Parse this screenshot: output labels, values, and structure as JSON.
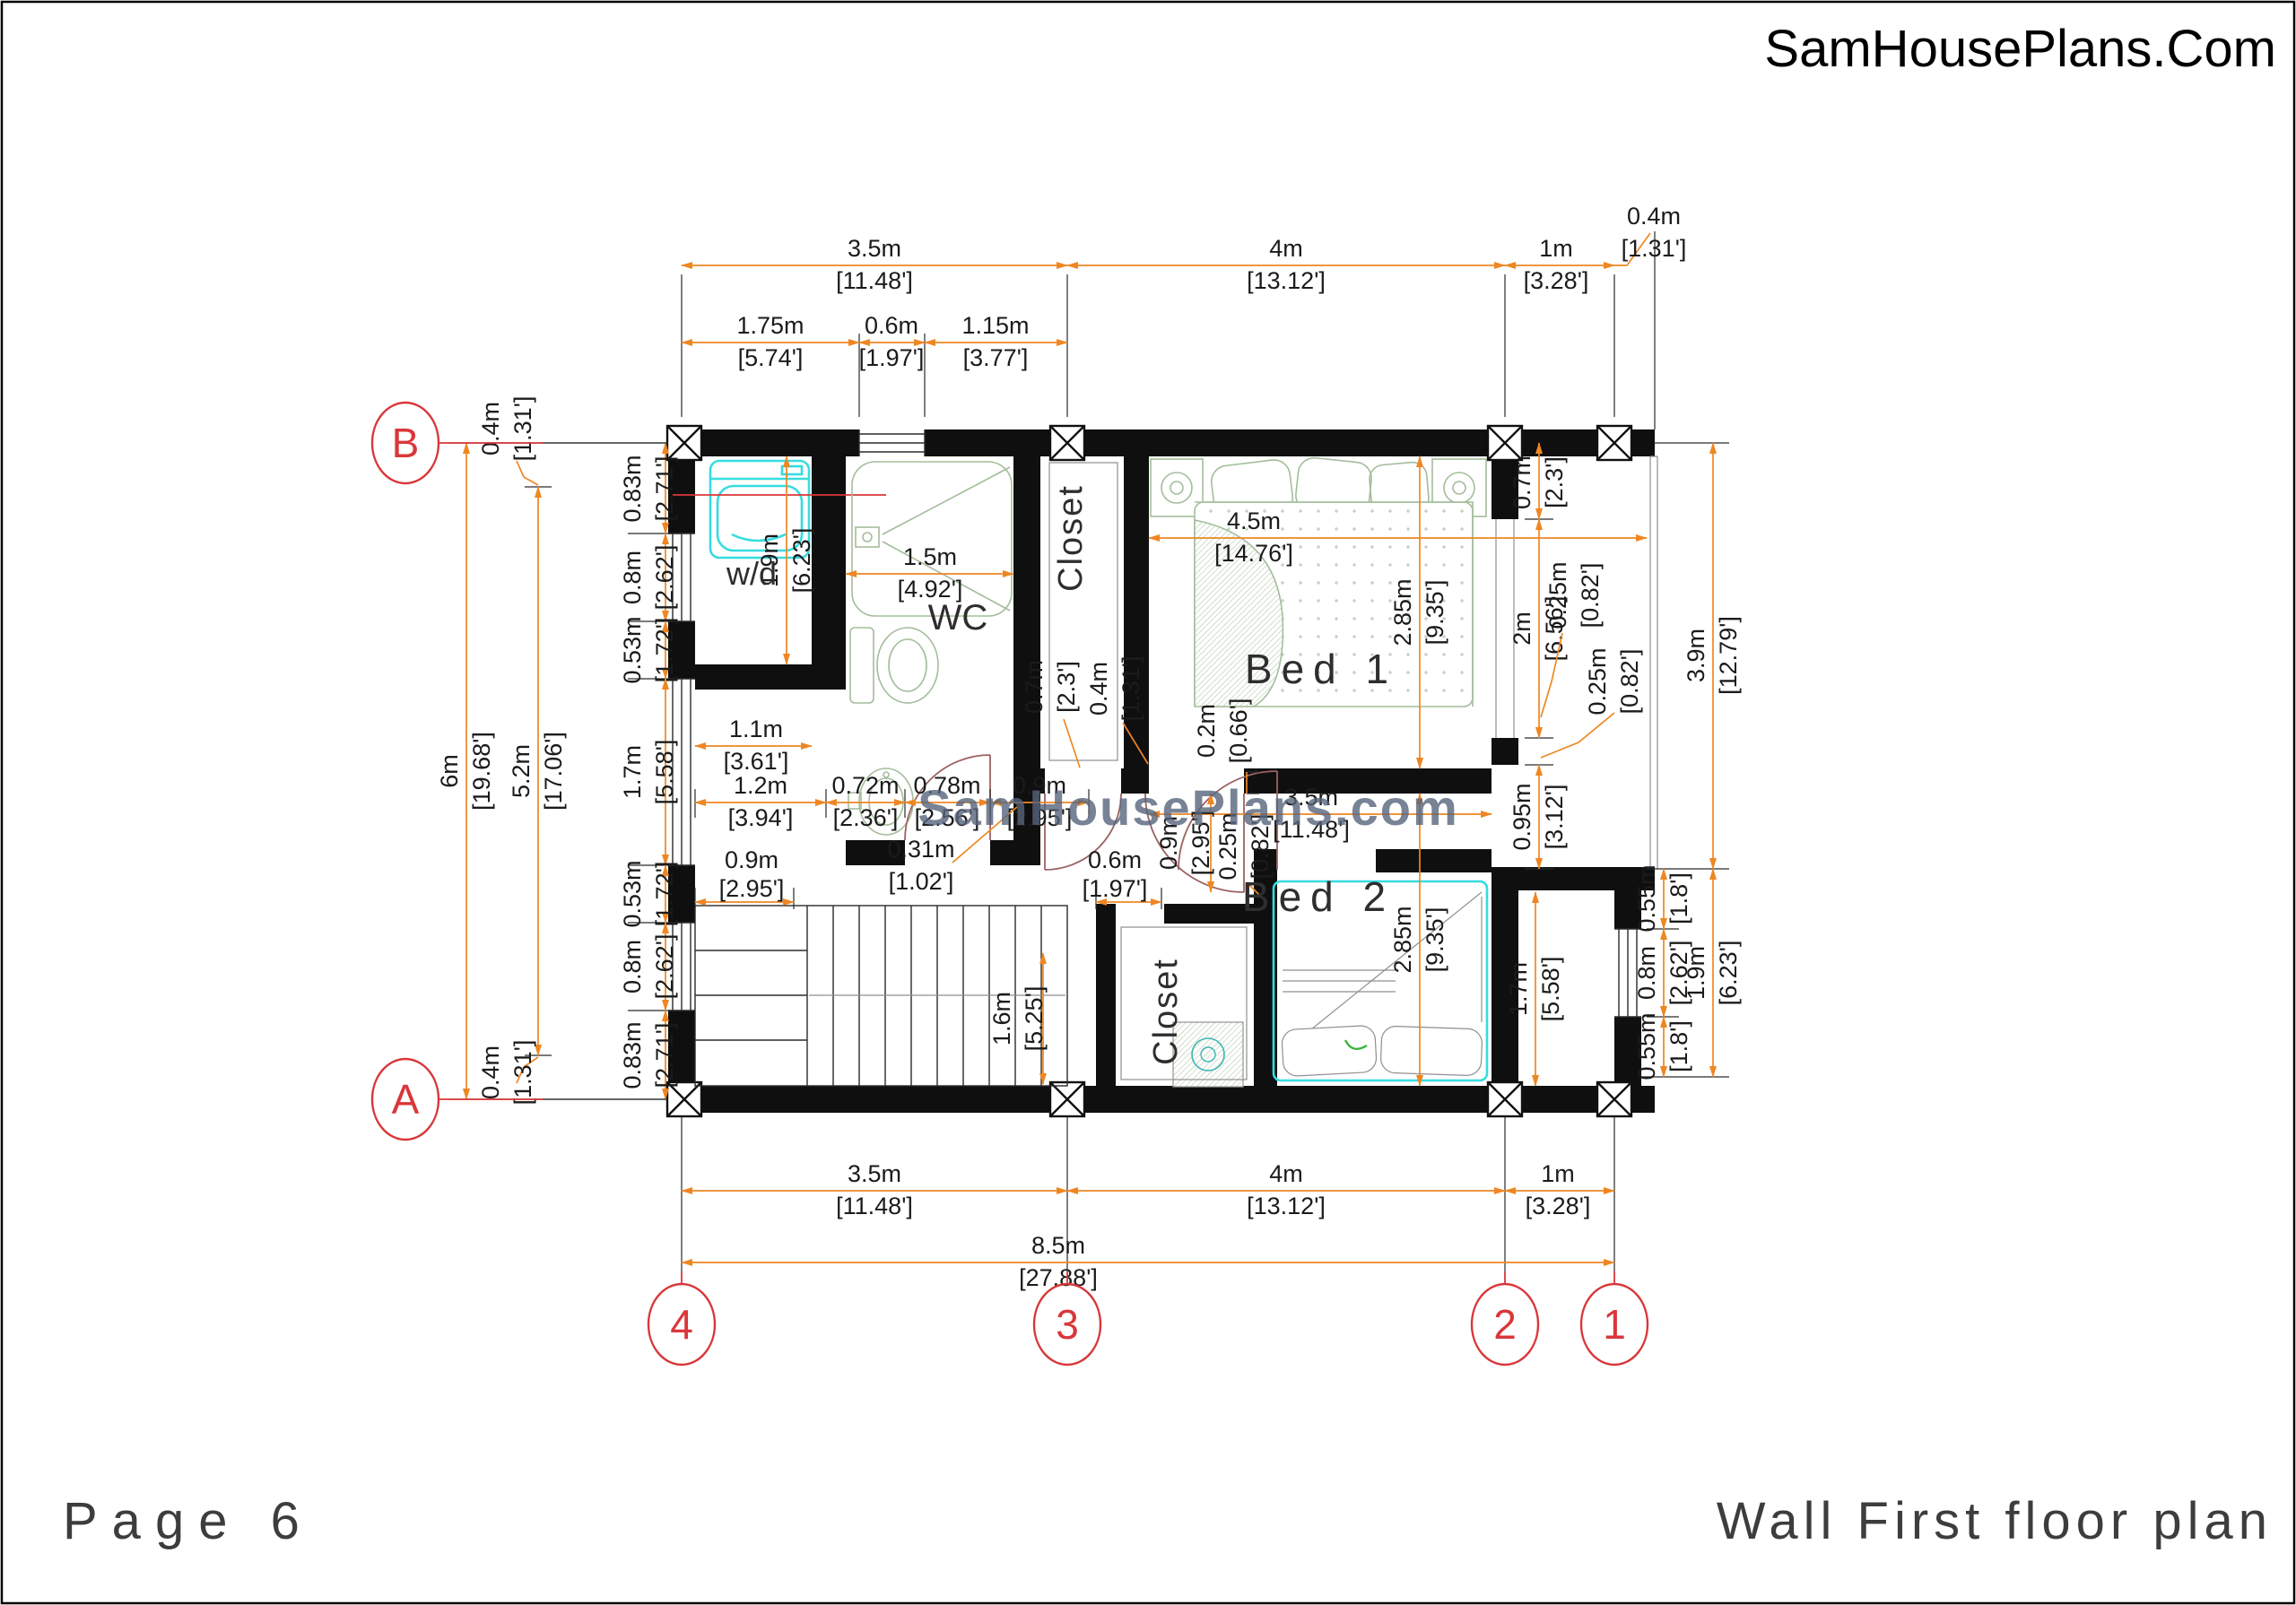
{
  "header": {
    "logo": "SamHousePlans.Com"
  },
  "footer": {
    "page": "Page 6",
    "plan_title": "Wall First floor plan"
  },
  "watermark": "SamHousePlans.com",
  "colors": {
    "dimension": "#ee8722",
    "grid": "#d9373a",
    "wall": "#0f0f0f",
    "fixture_green": "#a3bd9c",
    "fixture_cyan": "#36dce0",
    "door": "#9c6262",
    "watermark": "#56647c"
  },
  "grid_bubbles": {
    "left_top": "B",
    "left_bottom": "A",
    "bottom_1": "4",
    "bottom_2": "3",
    "bottom_3": "2",
    "bottom_4": "1"
  },
  "rooms": {
    "wd": "w/d",
    "wc": "WC",
    "closet_top": "Closet",
    "bed1": "Bed 1",
    "bed2": "Bed 2",
    "closet_bottom": "Closet"
  },
  "dims": {
    "t35": {
      "m": "3.5m",
      "ft": "[11.48']"
    },
    "t4": {
      "m": "4m",
      "ft": "[13.12']"
    },
    "t1": {
      "m": "1m",
      "ft": "[3.28']"
    },
    "t04": {
      "m": "0.4m",
      "ft": "[1.31']"
    },
    "s175": {
      "m": "1.75m",
      "ft": "[5.74']"
    },
    "s06": {
      "m": "0.6m",
      "ft": "[1.97']"
    },
    "s115": {
      "m": "1.15m",
      "ft": "[3.77']"
    },
    "b35": {
      "m": "3.5m",
      "ft": "[11.48']"
    },
    "b4": {
      "m": "4m",
      "ft": "[13.12']"
    },
    "b1": {
      "m": "1m",
      "ft": "[3.28']"
    },
    "b85": {
      "m": "8.5m",
      "ft": "[27.88']"
    },
    "l6": {
      "m": "6m",
      "ft": "[19.68']"
    },
    "l52": {
      "m": "5.2m",
      "ft": "[17.06']"
    },
    "l04t": {
      "m": "0.4m",
      "ft": "[1.31']"
    },
    "l04b": {
      "m": "0.4m",
      "ft": "[1.31']"
    },
    "c083a": {
      "m": "0.83m",
      "ft": "[2.71']"
    },
    "c08a": {
      "m": "0.8m",
      "ft": "[2.62']"
    },
    "c053a": {
      "m": "0.53m",
      "ft": "[1.72']"
    },
    "c17": {
      "m": "1.7m",
      "ft": "[5.58']"
    },
    "c053b": {
      "m": "0.53m",
      "ft": "[1.72']"
    },
    "c08b": {
      "m": "0.8m",
      "ft": "[2.62']"
    },
    "c083b": {
      "m": "0.83m",
      "ft": "[2.71']"
    },
    "r07": {
      "m": "0.7m",
      "ft": "[2.3']"
    },
    "r2": {
      "m": "2m",
      "ft": "[6.56']"
    },
    "r025": {
      "m": "0.25m",
      "ft": "[0.82']"
    },
    "r2025": {
      "m": "0.25m",
      "ft": "[0.82']"
    },
    "r095": {
      "m": "0.95m",
      "ft": "[3.12']"
    },
    "r39": {
      "m": "3.9m",
      "ft": "[12.79']"
    },
    "ro055a": {
      "m": "0.55m",
      "ft": "[1.8']"
    },
    "ro08": {
      "m": "0.8m",
      "ft": "[2.62']"
    },
    "ro055b": {
      "m": "0.55m",
      "ft": "[1.8']"
    },
    "ro19": {
      "m": "1.9m",
      "ft": "[6.23']"
    },
    "wd19": {
      "m": "1.9m",
      "ft": "[6.23']"
    },
    "wd11": {
      "m": "1.1m",
      "ft": "[3.61']"
    },
    "wc15": {
      "m": "1.5m",
      "ft": "[4.92']"
    },
    "h12": {
      "m": "1.2m",
      "ft": "[3.94']"
    },
    "h072": {
      "m": "0.72m",
      "ft": "[2.36']"
    },
    "h078": {
      "m": "0.78m",
      "ft": "[2.56']"
    },
    "h09": {
      "m": "0.9m",
      "ft": "[2.95']"
    },
    "hall35": {
      "m": "3.5m",
      "ft": "[11.48']"
    },
    "h031": {
      "m": "0.31m",
      "ft": "[1.02']"
    },
    "st09": {
      "m": "0.9m",
      "ft": "[2.95']"
    },
    "cl06": {
      "m": "0.6m",
      "ft": "[1.97']"
    },
    "st16": {
      "m": "1.6m",
      "ft": "[5.25']"
    },
    "b209": {
      "m": "0.9m",
      "ft": "[2.95']"
    },
    "b2025": {
      "m": "0.25m",
      "ft": "[0.82']"
    },
    "c07": {
      "m": "0.7m",
      "ft": "[2.3']"
    },
    "c04": {
      "m": "0.4m",
      "ft": "[1.31']"
    },
    "b102": {
      "m": "0.2m",
      "ft": "[0.66']"
    },
    "bed145": {
      "m": "4.5m",
      "ft": "[14.76']"
    },
    "bed1285": {
      "m": "2.85m",
      "ft": "[9.35']"
    },
    "bed2285": {
      "m": "2.85m",
      "ft": "[9.35']"
    },
    "bed217": {
      "m": "1.7m",
      "ft": "[5.58']"
    }
  }
}
